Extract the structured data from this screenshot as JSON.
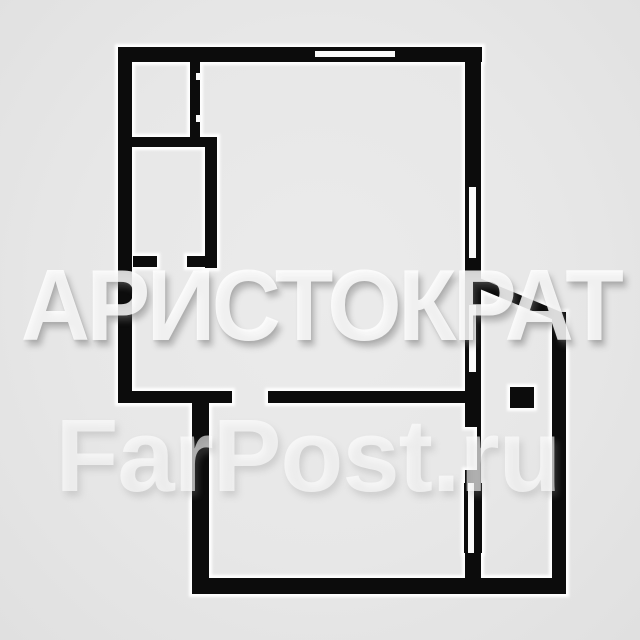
{
  "image": {
    "width": 640,
    "height": 640,
    "background_color": "#e7e7e7",
    "type_label": "apartment floor plan"
  },
  "watermarks": {
    "primary": {
      "text": "АРИСТОКРАТ",
      "color": "rgba(255,255,255,0.82)"
    },
    "secondary": {
      "text": "FarPost.ru",
      "color": "rgba(255,255,255,0.62)"
    }
  },
  "floor_plan": {
    "wall_color": "#0c0c0c",
    "halo_color": "#ffffff",
    "opening_color": "#fafafa",
    "halo_pad": 3,
    "walls": [
      {
        "name": "top-wall",
        "x": 118,
        "y": 47,
        "w": 364,
        "h": 15
      },
      {
        "name": "left-wall",
        "x": 118,
        "y": 47,
        "w": 14,
        "h": 356
      },
      {
        "name": "room-a-right-wall",
        "x": 190,
        "y": 47,
        "w": 10,
        "h": 91
      },
      {
        "name": "room-divider-wall",
        "x": 130,
        "y": 137,
        "w": 87,
        "h": 10
      },
      {
        "name": "room-b-right-wall",
        "x": 205,
        "y": 138,
        "w": 12,
        "h": 130
      },
      {
        "name": "room-b-bottom-wall-left",
        "x": 133,
        "y": 256,
        "w": 24,
        "h": 11
      },
      {
        "name": "room-b-bottom-wall-right",
        "x": 187,
        "y": 256,
        "w": 30,
        "h": 11
      },
      {
        "name": "hall-bottom-wall",
        "x": 118,
        "y": 391,
        "w": 114,
        "h": 12
      },
      {
        "name": "living-room-bottom-wall",
        "x": 268,
        "y": 391,
        "w": 200,
        "h": 12
      },
      {
        "name": "lower-room-left-wall",
        "x": 192,
        "y": 391,
        "w": 17,
        "h": 203
      },
      {
        "name": "bottom-wall",
        "x": 192,
        "y": 578,
        "w": 370,
        "h": 16
      },
      {
        "name": "right-wall-upper",
        "x": 465,
        "y": 47,
        "w": 16,
        "h": 380
      },
      {
        "name": "balcony-door-leaf",
        "x": 477,
        "y": 427,
        "w": 4,
        "h": 43
      },
      {
        "name": "right-wall-stub",
        "x": 465,
        "y": 470,
        "w": 16,
        "h": 13
      },
      {
        "name": "window-wall-lower",
        "x": 464,
        "y": 483,
        "w": 18,
        "h": 70
      },
      {
        "name": "right-wall-below-window",
        "x": 465,
        "y": 553,
        "w": 16,
        "h": 30
      },
      {
        "name": "right-outer-wall",
        "x": 552,
        "y": 312,
        "w": 14,
        "h": 282
      },
      {
        "name": "shaft-column",
        "x": 510,
        "y": 387,
        "w": 24,
        "h": 21
      }
    ],
    "diagonal_wall": {
      "name": "balcony-diagonal-wall",
      "x1": 476,
      "y1": 282,
      "x2": 560,
      "y2": 317,
      "width": 10
    },
    "openings": [
      {
        "name": "top-window",
        "x": 315,
        "y": 51,
        "w": 80,
        "h": 6
      },
      {
        "name": "right-window-1",
        "x": 469,
        "y": 187,
        "w": 7,
        "h": 71
      },
      {
        "name": "right-window-2",
        "x": 469,
        "y": 305,
        "w": 7,
        "h": 67
      },
      {
        "name": "lower-right-window",
        "x": 468,
        "y": 483,
        "w": 6,
        "h": 70
      },
      {
        "name": "door-jamb-upper",
        "x": 196,
        "y": 73,
        "w": 5,
        "h": 7
      },
      {
        "name": "door-jamb-lower",
        "x": 196,
        "y": 115,
        "w": 5,
        "h": 7
      }
    ]
  }
}
